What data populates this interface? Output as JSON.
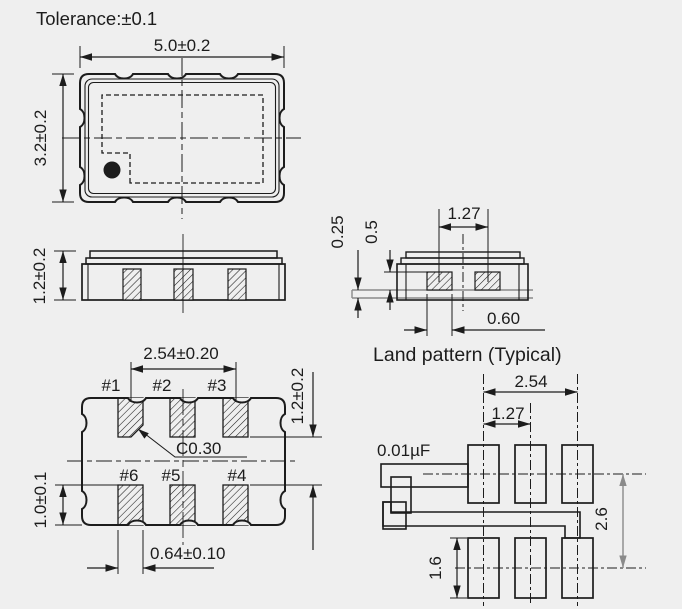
{
  "tolerance_note": "Tolerance:±0.1",
  "top_view": {
    "dim_width": "5.0±0.2",
    "dim_height": "3.2±0.2"
  },
  "side_view": {
    "dim_height": "1.2±0.2"
  },
  "cross_section": {
    "dim_pad_pitch": "1.27",
    "dim_land_thickness": "0.25",
    "dim_pad_height": "0.5",
    "dim_pad_width": "0.60"
  },
  "caption": {
    "land_pattern": "Land pattern (Typical)"
  },
  "bottom_view": {
    "dim_pad_pitch": "2.54±0.20",
    "dim_row_gap": "1.2±0.2",
    "chamfer_note": "C0.30",
    "dim_pad_length": "1.0±0.1",
    "dim_pad_width": "0.64±0.10",
    "pins": [
      "#1",
      "#2",
      "#3",
      "#6",
      "#5",
      "#4"
    ]
  },
  "land_pattern": {
    "dim_pad_pitch": "2.54",
    "dim_half_pitch": "1.27",
    "capacitor_value": "0.01µF",
    "dim_row_pitch": "2.6",
    "dim_pad_length": "1.6"
  },
  "colors": {
    "line": "#1c1c1c",
    "land_gray": "#8a8a8a",
    "background": "#efefef"
  }
}
